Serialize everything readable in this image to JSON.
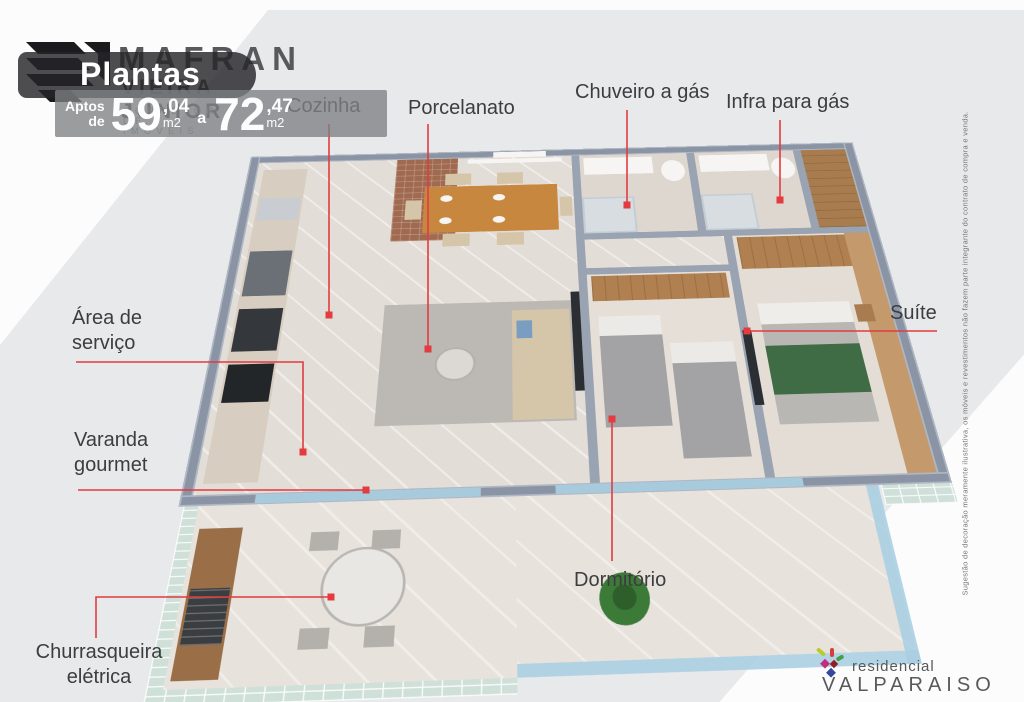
{
  "colors": {
    "accent_red": "#e23b40",
    "background": "#e8e9eb",
    "wall": "#8a94a4",
    "mint_tile": "#cfe0d9",
    "glass_blue": "#aacfe2",
    "wood": "#c8873f",
    "label_text": "#3d3d40",
    "logo_gray": "#58595b"
  },
  "branding": {
    "agency_name": "MAFRAN",
    "agency_name2": "VIEIRA JUNIOR",
    "agency_tagline": "CORRETOR DE IMÓVEIS",
    "plantas_title": "Plantas",
    "area": {
      "aptos": "Aptos",
      "de": "de",
      "min_value": "59",
      "min_decimal": ",04",
      "min_unit": "m2",
      "separator": "a",
      "max_value": "72",
      "max_decimal": ",47",
      "max_unit": "m2"
    }
  },
  "annotations": [
    {
      "label": "Cozinha"
    },
    {
      "label": "Porcelanato"
    },
    {
      "label": "Chuveiro a gás"
    },
    {
      "label": "Infra para gás"
    },
    {
      "label": "Suíte"
    },
    {
      "label": "Área de serviço"
    },
    {
      "label": "Varanda gourmet"
    },
    {
      "label": "Churrasqueira elétrica"
    },
    {
      "label": "Dormitório"
    }
  ],
  "disclaimer": "Sugestão de decoração meramente ilustrativa, os móveis e revestimentos não fazem parte integrante do contrato de compra e venda.",
  "footer": {
    "brand_line1": "residencial",
    "brand_line2": "VALPARAISO"
  }
}
